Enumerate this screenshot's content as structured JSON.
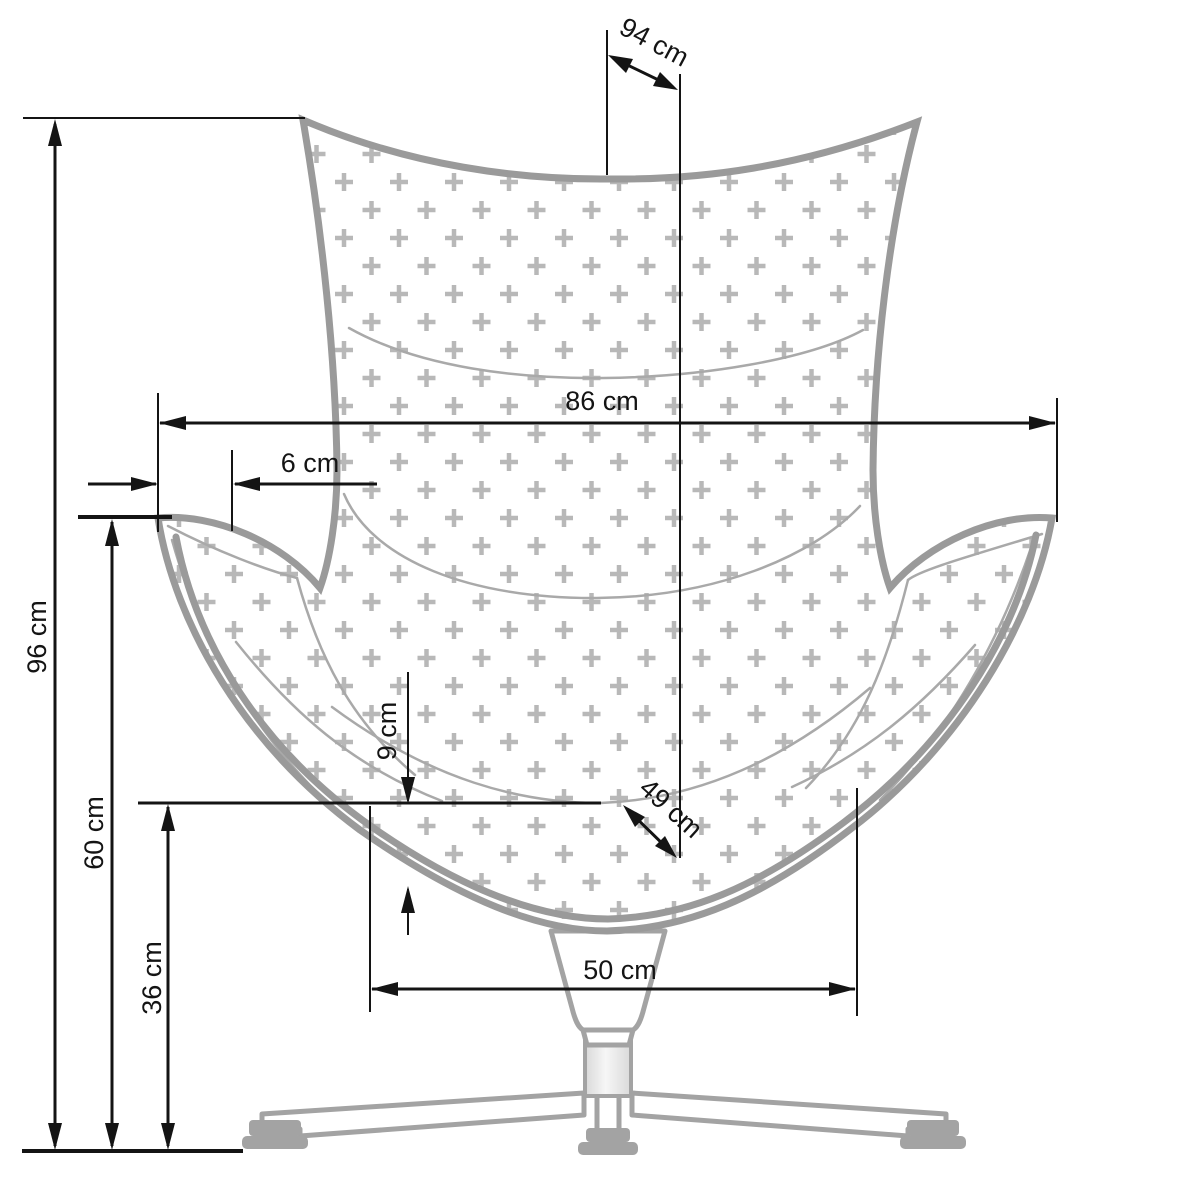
{
  "diagram": {
    "subject": "egg-chair-front-view-dimension-drawing",
    "unit": "cm",
    "dimensions": {
      "depth_total": {
        "value": 94,
        "unit": "cm",
        "label": "94 cm"
      },
      "width_total": {
        "value": 86,
        "unit": "cm",
        "label": "86 cm"
      },
      "armrest_offset": {
        "value": 6,
        "unit": "cm",
        "label": "6 cm"
      },
      "height_total": {
        "value": 96,
        "unit": "cm",
        "label": "96 cm"
      },
      "armrest_height": {
        "value": 60,
        "unit": "cm",
        "label": "60 cm"
      },
      "seat_height": {
        "value": 36,
        "unit": "cm",
        "label": "36 cm"
      },
      "cushion_thickness": {
        "value": 9,
        "unit": "cm",
        "label": "9 cm"
      },
      "seat_depth": {
        "value": 49,
        "unit": "cm",
        "label": "49 cm"
      },
      "seat_width": {
        "value": 50,
        "unit": "cm",
        "label": "50 cm"
      }
    }
  }
}
